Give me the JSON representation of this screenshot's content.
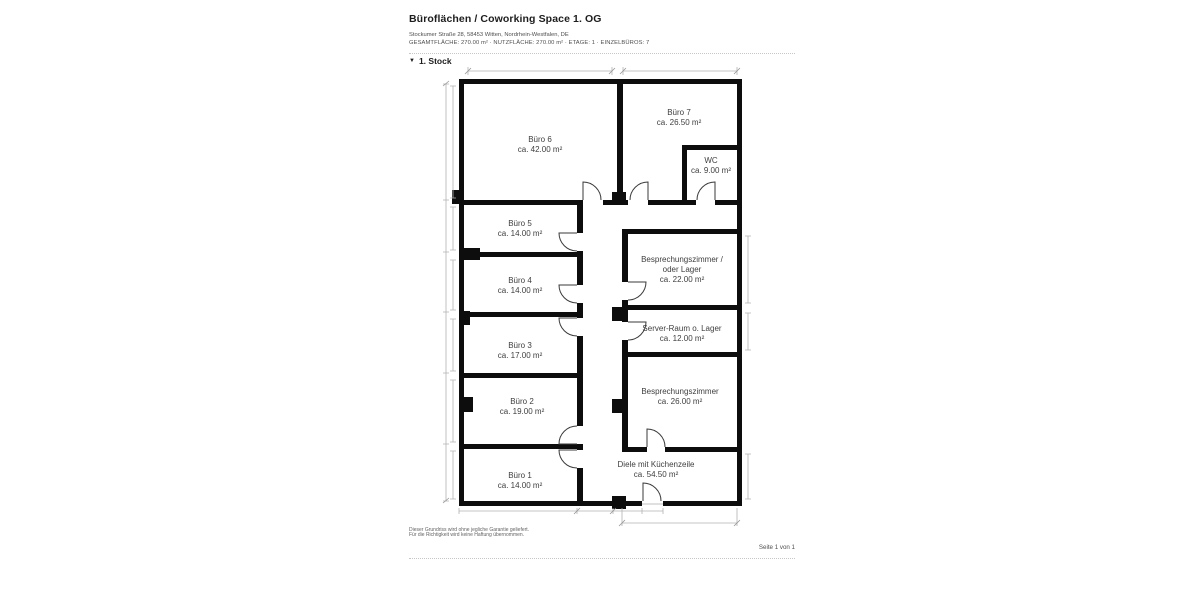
{
  "header": {
    "title": "Büroflächen / Coworking Space 1. OG",
    "address": "Stockumer Straße 28, 58453 Witten, Nordrhein-Westfalen, DE",
    "summary": "GESAMTFLÄCHE: 270.00 m² · NUTZFLÄCHE: 270.00 m² · ETAGE: 1 · EINZELBÜROS: 7"
  },
  "section": {
    "collapse_icon": "▼",
    "label": "1. Stock"
  },
  "floorplan": {
    "rooms": [
      {
        "name": "Büro 6",
        "area": "ca. 42.00 m²"
      },
      {
        "name": "Büro 7",
        "area": "ca. 26.50 m²"
      },
      {
        "name": "WC",
        "area": "ca. 9.00 m²"
      },
      {
        "name": "Büro 5",
        "area": "ca. 14.00 m²"
      },
      {
        "name": "Büro 4",
        "area": "ca. 14.00 m²"
      },
      {
        "name": "Büro 3",
        "area": "ca. 17.00 m²"
      },
      {
        "name": "Büro 2",
        "area": "ca. 19.00 m²"
      },
      {
        "name": "Büro 1",
        "area": "ca. 14.00 m²"
      },
      {
        "name_line1": "Besprechungszimmer /",
        "name_line2": "oder Lager",
        "area": "ca. 22.00 m²"
      },
      {
        "name": "Server-Raum o. Lager",
        "area": "ca. 12.00 m²"
      },
      {
        "name": "Besprechungszimmer",
        "area": "ca. 26.00 m²"
      },
      {
        "name": "Diele mit Küchenzeile",
        "area": "ca. 54.50 m²"
      }
    ]
  },
  "footer": {
    "disclaimer_line1": "Dieser Grundriss wird ohne jegliche Garantie geliefert.",
    "disclaimer_line2": "Für die Richtigkeit wird keine Haftung übernommen.",
    "page_label": "Seite 1 von 1"
  },
  "colors": {
    "wall": "#0d0d0d",
    "room_label": "#3e3e3e",
    "dimension_line": "#b3b3b3",
    "background": "#ffffff"
  }
}
